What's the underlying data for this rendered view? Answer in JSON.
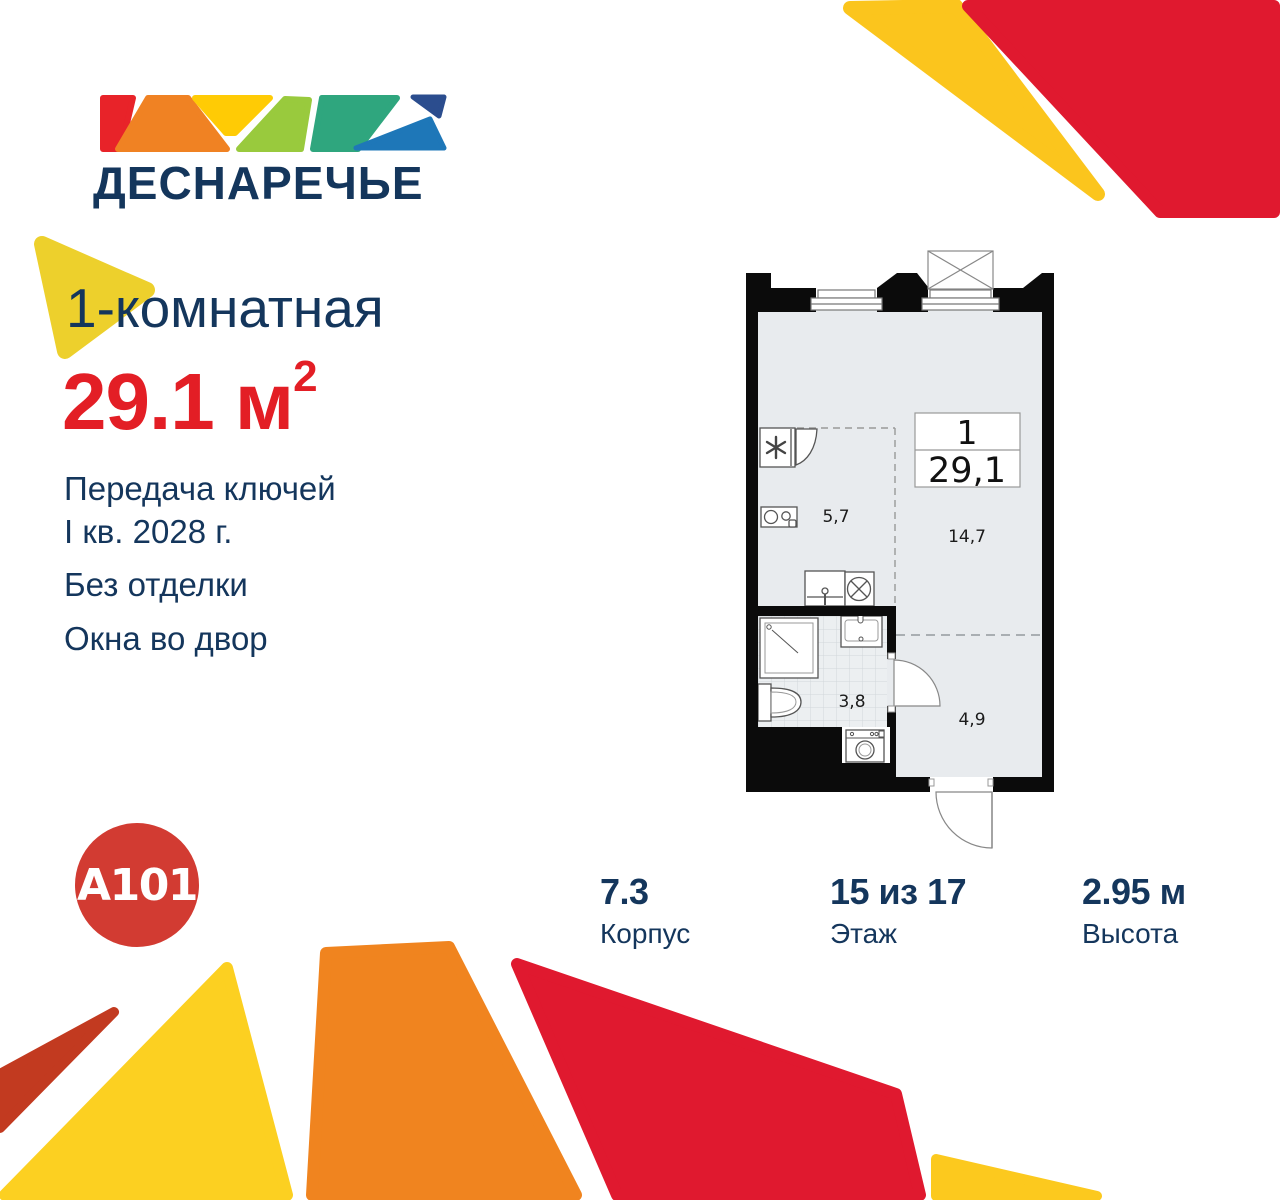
{
  "brand": {
    "wordmark": "ДЕСНАРЕЧЬЕ",
    "developer": "A101"
  },
  "headline": {
    "rooms": "1-комнатная",
    "area": "29.1 м",
    "area_sup": "2"
  },
  "details": {
    "handover_line1": "Передача ключей",
    "handover_line2": "I кв. 2028 г.",
    "finish": "Без отделки",
    "view": "Окна во двор"
  },
  "plan": {
    "info_rooms": "1",
    "info_area": "29,1",
    "areas": {
      "kitchen": "5,7",
      "living": "14,7",
      "bathroom": "3,8",
      "hallway": "4,9"
    }
  },
  "stats": [
    {
      "value": "7.3",
      "label": "Корпус"
    },
    {
      "value": "15 из 17",
      "label": "Этаж"
    },
    {
      "value": "2.95 м",
      "label": "Высота"
    }
  ],
  "palette": {
    "navy_text": "#14365C",
    "accent_red": "#E31E25",
    "crimson_shape": "#E0192F",
    "yellow_shape": "#FBC51D",
    "yellow_big": "#FCD021",
    "yellow_headline": "#EDD02C",
    "orange_shape": "#F0841F",
    "brick_shape": "#C23A20",
    "a101_red": "#D23B32",
    "band_red": "#E82329",
    "band_orange": "#F08223",
    "band_yellow": "#FFCB05",
    "band_lime": "#99CA3D",
    "band_teal": "#2FA67E",
    "band_darkblue": "#2B4D8E",
    "band_lightblue": "#1E77B8",
    "plan_floor": "#E8EBEE"
  }
}
